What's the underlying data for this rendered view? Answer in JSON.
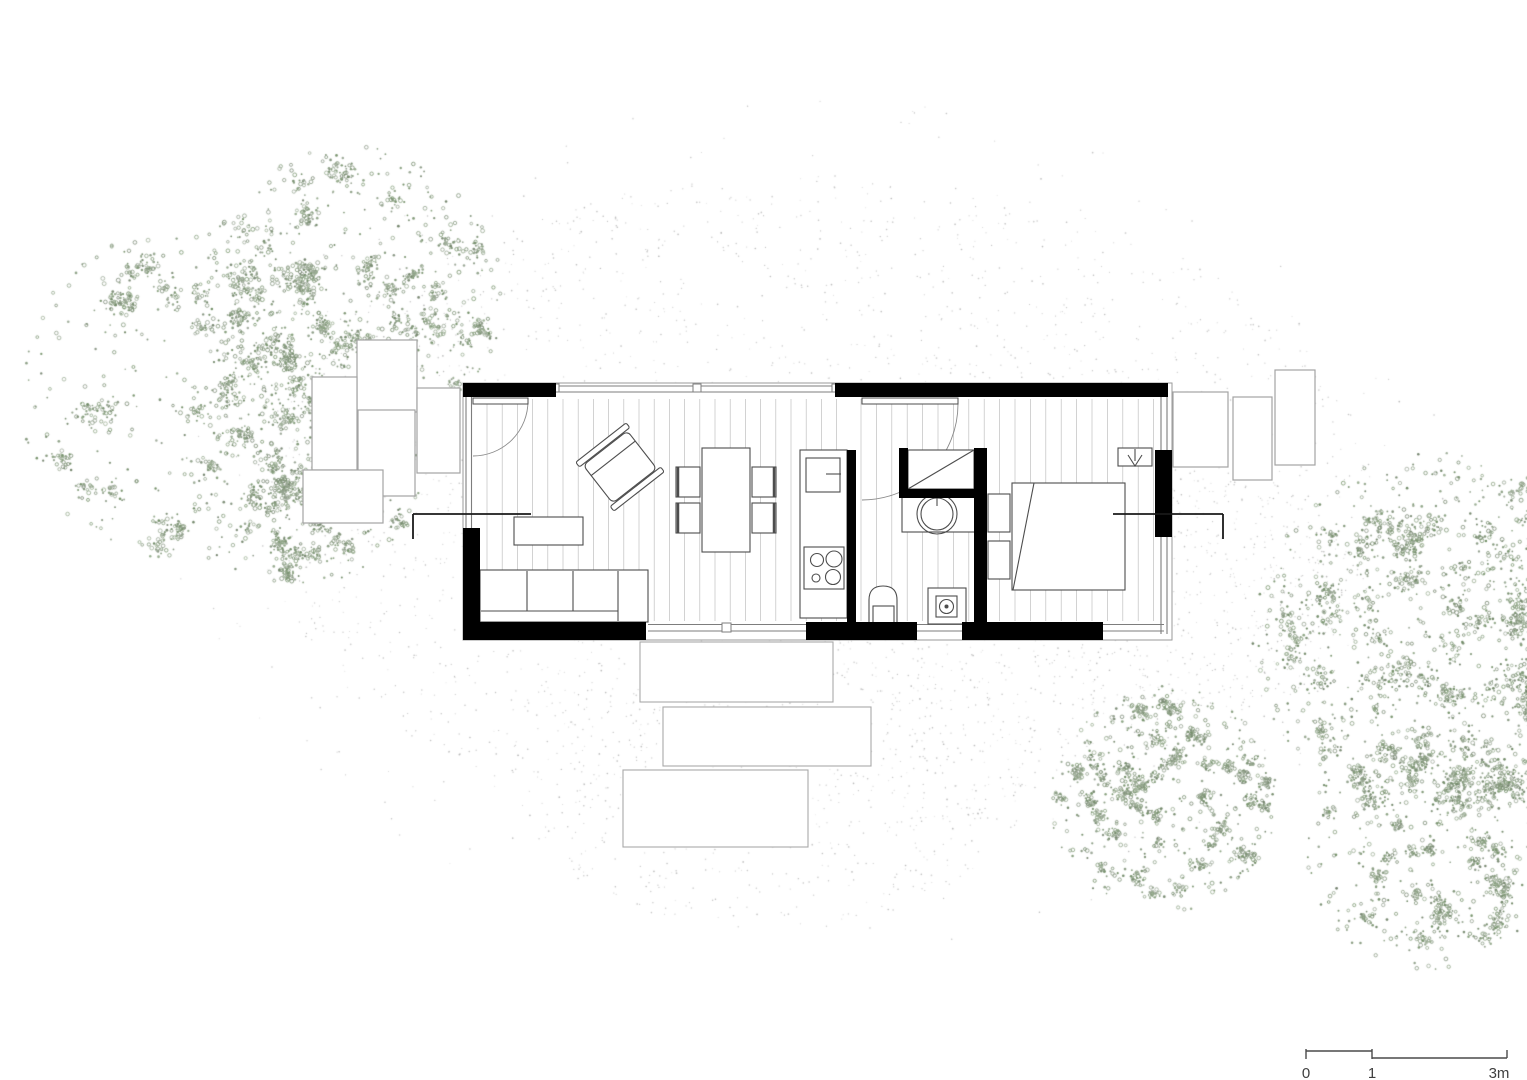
{
  "scale_bar": {
    "t0": "0",
    "t1": "1",
    "t2": "3m"
  },
  "colors": {
    "paper": "#ffffff",
    "wall": "#000000",
    "furniture_line": "#4d4d4d",
    "window_line": "#7d7d7d",
    "house_outline": "#9a9a9a",
    "plank_line": "#c0c0c0",
    "deck_stroke": "#a3a3a3",
    "step_stroke": "#a8a8a8",
    "door_arc": "#8a8a8a",
    "section_line": "#1a1a1a",
    "tree_dot": "#87927e",
    "ground_dot": "#b3b3b3",
    "scale_text": "#3f3f3f",
    "scale_line": "#4a4a4a"
  },
  "plan": {
    "house": {
      "x": 463,
      "y": 383,
      "w": 709,
      "h": 257
    },
    "plank_regions": [
      {
        "x0": 487,
        "x1": 845,
        "step": 15.2,
        "y0": 399,
        "y1": 621
      },
      {
        "x0": 861,
        "x1": 1158,
        "step": 15.4,
        "y0": 399,
        "y1": 621
      }
    ],
    "walls": [
      {
        "name": "wall-top-left",
        "r": [
          463,
          383,
          93,
          14
        ]
      },
      {
        "name": "wall-top-right",
        "r": [
          835,
          383,
          333,
          14
        ]
      },
      {
        "name": "wall-left-lower",
        "r": [
          463,
          528,
          17,
          112
        ]
      },
      {
        "name": "wall-bottom-left",
        "r": [
          463,
          622,
          183,
          18
        ]
      },
      {
        "name": "wall-bottom-mid",
        "r": [
          806,
          622,
          111,
          18
        ]
      },
      {
        "name": "wall-bottom-right",
        "r": [
          962,
          622,
          141,
          18
        ]
      },
      {
        "name": "wall-kitchen",
        "r": [
          847,
          450,
          9,
          172
        ]
      },
      {
        "name": "wall-shower-west",
        "r": [
          899,
          448,
          9,
          49
        ]
      },
      {
        "name": "wall-shower-south",
        "r": [
          899,
          489,
          75,
          9
        ]
      },
      {
        "name": "wall-bedroom-west",
        "r": [
          974,
          448,
          13,
          182
        ]
      },
      {
        "name": "wall-right-segment",
        "r": [
          1155,
          450,
          17,
          87
        ]
      }
    ],
    "windows": [
      {
        "name": "window-north",
        "lines": [
          [
            556,
            386,
            835,
            386
          ],
          [
            556,
            392,
            835,
            392
          ]
        ]
      },
      {
        "name": "window-west",
        "lines": [
          [
            466,
            397,
            466,
            528
          ],
          [
            471.5,
            397,
            471.5,
            528
          ]
        ]
      },
      {
        "name": "sliding-door-south",
        "lines": [
          [
            648,
            624.5,
            806,
            624.5
          ],
          [
            648,
            631,
            806,
            631
          ]
        ]
      },
      {
        "name": "window-bath-south",
        "lines": [
          [
            917,
            624.5,
            962,
            624.5
          ],
          [
            917,
            631,
            962,
            631
          ]
        ]
      },
      {
        "name": "window-east-upper",
        "lines": [
          [
            1161,
            393,
            1161,
            450
          ],
          [
            1167,
            393,
            1167,
            450
          ]
        ]
      },
      {
        "name": "window-corner-east",
        "lines": [
          [
            1161,
            537,
            1161,
            634
          ],
          [
            1167,
            537,
            1167,
            634
          ]
        ]
      },
      {
        "name": "window-corner-south",
        "lines": [
          [
            1103,
            624.5,
            1164,
            624.5
          ],
          [
            1103,
            631,
            1164,
            631
          ]
        ]
      }
    ],
    "window_marks": [
      [
        693,
        384,
        8,
        8
      ],
      [
        553,
        384,
        6,
        8
      ],
      [
        832,
        384,
        6,
        8
      ],
      [
        722,
        623,
        9,
        9
      ]
    ],
    "doors": [
      {
        "name": "entry-door",
        "leaf": [
          473,
          398,
          55,
          6
        ],
        "arc": "M528,401 A55 55 0 0 1 473,456"
      },
      {
        "name": "bathroom-door",
        "leaf": [
          862,
          398,
          96,
          6
        ],
        "arc": "M958,404 A96 96 0 0 1 862,500"
      }
    ],
    "furniture": [
      {
        "name": "sofa",
        "shapes": [
          {
            "k": "r",
            "v": [
              480,
              570,
              168,
              52
            ]
          },
          {
            "k": "l",
            "v": [
              527,
              571,
              527,
              611
            ]
          },
          {
            "k": "l",
            "v": [
              573,
              571,
              573,
              611
            ]
          },
          {
            "k": "l",
            "v": [
              618,
              571,
              618,
              621
            ]
          },
          {
            "k": "l",
            "v": [
              481,
              611,
              618,
              611
            ]
          }
        ]
      },
      {
        "name": "coffee-table",
        "shapes": [
          {
            "k": "r",
            "v": [
              514,
              517,
              69,
              28
            ]
          }
        ]
      },
      {
        "name": "armchair",
        "rotate": [
          -38,
          620,
          467
        ],
        "shapes": [
          {
            "k": "r",
            "v": [
              592,
              443,
              56,
              48
            ],
            "rx": 5
          },
          {
            "k": "r",
            "v": [
              588,
              436,
              64,
              6
            ],
            "rx": 2
          },
          {
            "k": "r",
            "v": [
              588,
              492,
              64,
              6
            ],
            "rx": 2
          },
          {
            "k": "l",
            "v": [
              592,
              456,
              648,
              456
            ]
          }
        ]
      },
      {
        "name": "dining-table",
        "shapes": [
          {
            "k": "r",
            "v": [
              702,
              448,
              48,
              104
            ]
          }
        ]
      },
      {
        "name": "dining-chair",
        "shapes": [
          {
            "k": "r",
            "v": [
              676,
              467,
              24,
              30
            ]
          },
          {
            "k": "l",
            "v": [
              678,
              467,
              678,
              497
            ],
            "w": 2.5
          }
        ]
      },
      {
        "name": "dining-chair",
        "shapes": [
          {
            "k": "r",
            "v": [
              676,
              503,
              24,
              30
            ]
          },
          {
            "k": "l",
            "v": [
              678,
              503,
              678,
              533
            ],
            "w": 2.5
          }
        ]
      },
      {
        "name": "dining-chair",
        "shapes": [
          {
            "k": "r",
            "v": [
              752,
              467,
              24,
              30
            ]
          },
          {
            "k": "l",
            "v": [
              774,
              467,
              774,
              497
            ],
            "w": 2.5
          }
        ]
      },
      {
        "name": "dining-chair",
        "shapes": [
          {
            "k": "r",
            "v": [
              752,
              503,
              24,
              30
            ]
          },
          {
            "k": "l",
            "v": [
              774,
              503,
              774,
              533
            ],
            "w": 2.5
          }
        ]
      },
      {
        "name": "kitchen-counter",
        "shapes": [
          {
            "k": "r",
            "v": [
              800,
              450,
              47,
              168
            ]
          }
        ]
      },
      {
        "name": "kitchen-sink",
        "shapes": [
          {
            "k": "r",
            "v": [
              806,
              458,
              34,
              34
            ]
          },
          {
            "k": "l",
            "v": [
              826,
              474,
              841,
              474
            ]
          }
        ]
      },
      {
        "name": "cooktop",
        "shapes": [
          {
            "k": "r",
            "v": [
              804,
              547,
              40,
              42
            ]
          },
          {
            "k": "c",
            "v": [
              817,
              560,
              6.5
            ]
          },
          {
            "k": "c",
            "v": [
              834,
              559,
              8
            ]
          },
          {
            "k": "c",
            "v": [
              816,
              578,
              4
            ]
          },
          {
            "k": "c",
            "v": [
              833,
              577,
              7.5
            ]
          }
        ]
      },
      {
        "name": "toilet",
        "shapes": [
          {
            "k": "p",
            "d": "M869 627 L869 600 Q869 586 883 586 Q897 586 897 600 L897 627 Z",
            "f": "w"
          },
          {
            "k": "r",
            "v": [
              873,
              606,
              21,
              20
            ]
          }
        ]
      },
      {
        "name": "washbasin",
        "shapes": [
          {
            "k": "r",
            "v": [
              902,
              495,
              75,
              37
            ]
          },
          {
            "k": "c",
            "v": [
              937,
              514,
              20
            ]
          },
          {
            "k": "c",
            "v": [
              937,
              514,
              16
            ]
          },
          {
            "k": "l",
            "v": [
              937,
              492,
              937,
              506
            ]
          }
        ]
      },
      {
        "name": "shower-shaft",
        "shapes": [
          {
            "k": "r",
            "v": [
              908,
              450,
              66,
              39
            ]
          },
          {
            "k": "l",
            "v": [
              908,
              489,
              974,
              450
            ]
          }
        ]
      },
      {
        "name": "shower-drain",
        "shapes": [
          {
            "k": "r",
            "v": [
              928,
              588,
              38,
              36
            ]
          },
          {
            "k": "r",
            "v": [
              936,
              596,
              21,
              21
            ]
          },
          {
            "k": "c",
            "v": [
              946.5,
              606.5,
              7
            ]
          },
          {
            "k": "c",
            "v": [
              946.5,
              606.5,
              2
            ],
            "f": "s"
          }
        ]
      },
      {
        "name": "bed",
        "shapes": [
          {
            "k": "r",
            "v": [
              1012,
              483,
              113,
              107
            ]
          },
          {
            "k": "l",
            "v": [
              1034,
              483,
              1013,
              590
            ]
          },
          {
            "k": "r",
            "v": [
              988,
              494,
              22,
              38
            ]
          },
          {
            "k": "r",
            "v": [
              988,
              541,
              22,
              38
            ]
          }
        ]
      },
      {
        "name": "wardrobe-arrow-marker",
        "shapes": [
          {
            "k": "r",
            "v": [
              1118,
              448,
              34,
              18
            ]
          },
          {
            "k": "l",
            "v": [
              1135,
              449,
              1135,
              461
            ]
          },
          {
            "k": "p",
            "d": "M1128 455 L1135 466 L1142 455",
            "f": "n"
          }
        ]
      }
    ],
    "decks": [
      [
        357,
        340,
        60,
        72
      ],
      [
        358,
        410,
        57,
        86
      ],
      [
        417,
        388,
        43,
        85
      ],
      [
        312,
        377,
        45,
        93
      ],
      [
        303,
        470,
        80,
        53
      ]
    ],
    "steps": [
      [
        640,
        642,
        193,
        60
      ],
      [
        663,
        707,
        208,
        59
      ],
      [
        623,
        770,
        185,
        77
      ]
    ],
    "platforms": [
      [
        1173,
        392,
        55,
        75
      ],
      [
        1233,
        397,
        39,
        83
      ],
      [
        1275,
        370,
        40,
        95
      ]
    ],
    "section_marks": [
      [
        413,
        514,
        531,
        514
      ],
      [
        413,
        514,
        413,
        539
      ],
      [
        1113,
        514,
        1223,
        514
      ],
      [
        1223,
        514,
        1223,
        539
      ]
    ]
  },
  "vegetation": {
    "clusters": [
      {
        "cx": 185,
        "cy": 395,
        "r": 168,
        "n": 820
      },
      {
        "cx": 352,
        "cy": 298,
        "r": 152,
        "n": 1600
      },
      {
        "cx": 298,
        "cy": 458,
        "r": 128,
        "n": 950
      },
      {
        "cx": 1440,
        "cy": 638,
        "r": 188,
        "n": 2500
      },
      {
        "cx": 1164,
        "cy": 800,
        "r": 114,
        "n": 1250
      },
      {
        "cx": 1428,
        "cy": 848,
        "r": 122,
        "n": 950
      }
    ],
    "ground_patches": [
      {
        "cx": 812,
        "cy": 505,
        "rx": 560,
        "ry": 330,
        "n": 2400
      },
      {
        "cx": 770,
        "cy": 760,
        "rx": 270,
        "ry": 170,
        "n": 650
      },
      {
        "cx": 1180,
        "cy": 590,
        "rx": 190,
        "ry": 130,
        "n": 420
      },
      {
        "cx": 812,
        "cy": 520,
        "rx": 650,
        "ry": 430,
        "n": 380
      }
    ]
  }
}
